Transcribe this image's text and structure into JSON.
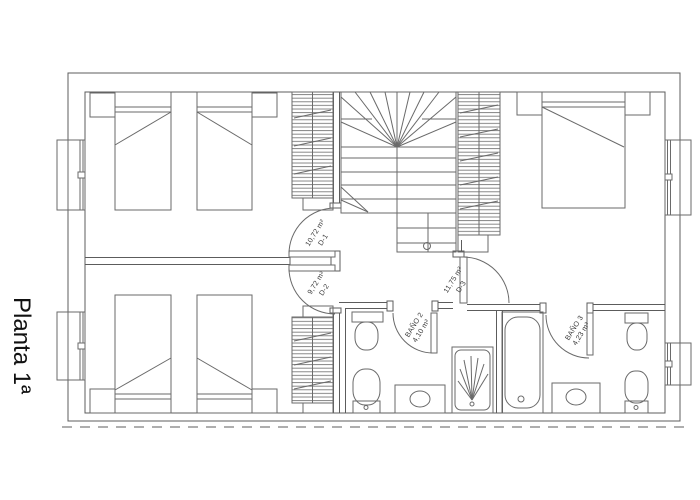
{
  "title": "Planta 1ª",
  "rooms": {
    "d1": {
      "name": "D-1",
      "area": "10,72 m²"
    },
    "d2": {
      "name": "D-2",
      "area": "9,72 m²"
    },
    "d3": {
      "name": "D-3",
      "area": "11,75 m²"
    },
    "bano2": {
      "name": "BAÑO 2",
      "area": "4,10 m²"
    },
    "bano3": {
      "name": "BAÑO 3",
      "area": "4,23 m²"
    }
  },
  "colors": {
    "line": "#6a6a6a",
    "wall": "#5c5c5c",
    "text": "#3d3d3d",
    "title": "#111111",
    "background": "#ffffff"
  }
}
